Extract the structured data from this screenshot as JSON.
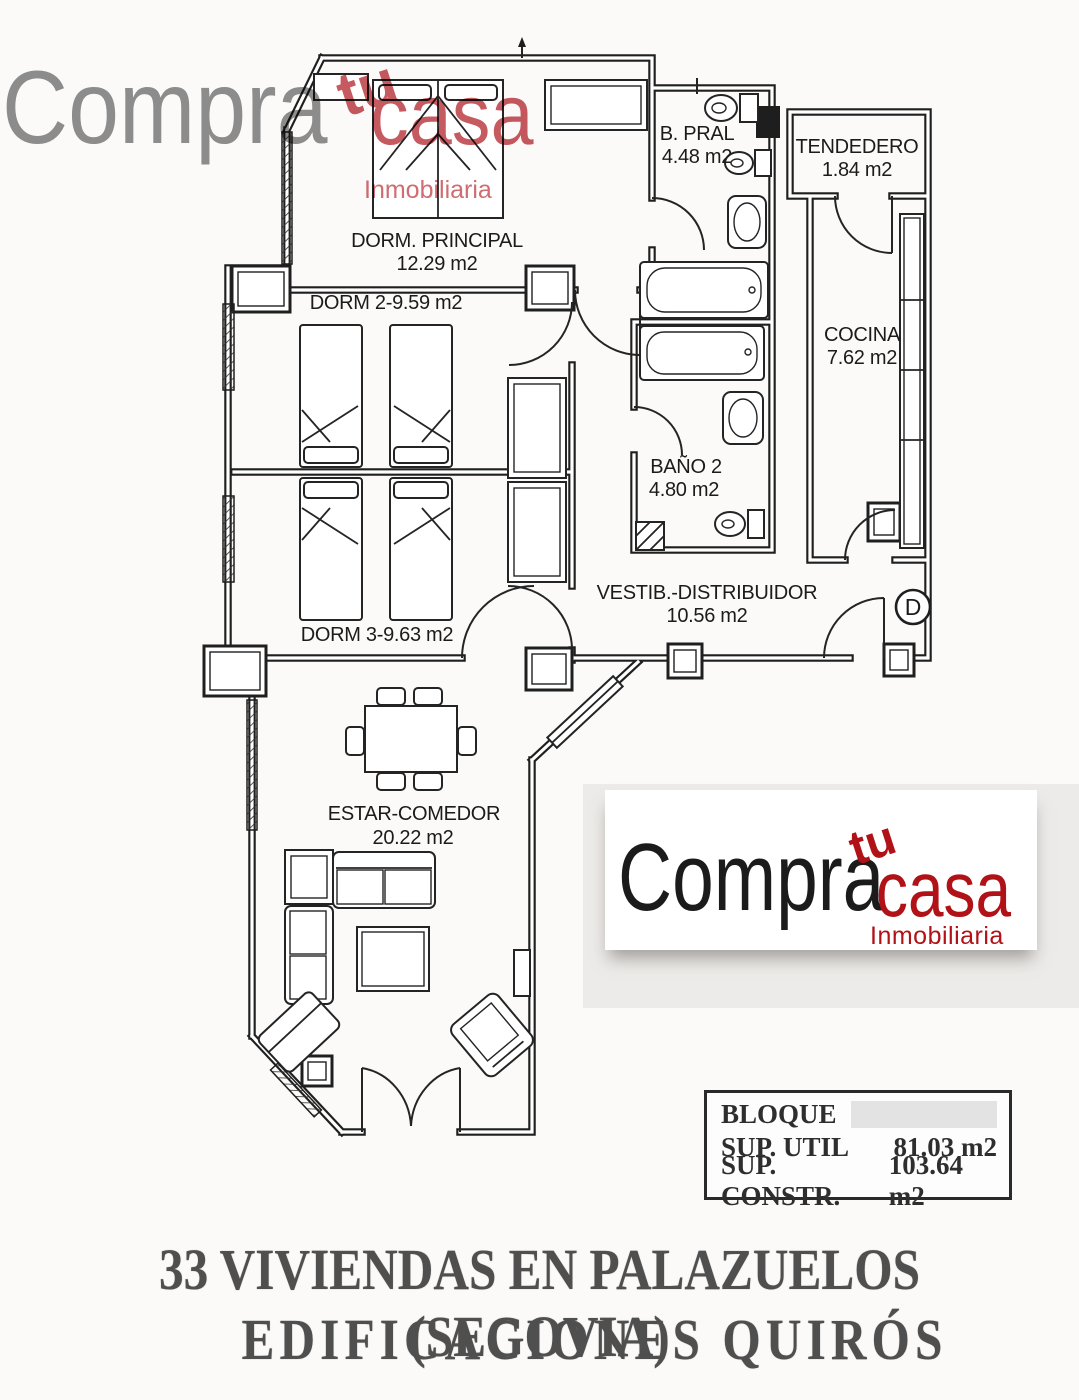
{
  "brand": {
    "word1": "Compra",
    "word2": "tu",
    "word3": "casa",
    "subtitle": "Inmobiliaria"
  },
  "colors": {
    "brand_gray": "#8f8f8f",
    "brand_red": "#b01217",
    "brand_red_faded": "#c55a60",
    "plan_line": "#1f1f1f",
    "caption_gray": "#4f4f4f"
  },
  "plan": {
    "rooms": {
      "dorm_principal": {
        "name": "DORM. PRINCIPAL",
        "area": "12.29 m2"
      },
      "dorm2": {
        "label": "DORM 2-9.59 m2"
      },
      "dorm3": {
        "label": "DORM 3-9.63 m2"
      },
      "b_pral": {
        "name": "B. PRAL",
        "area": "4.48 m2"
      },
      "tendedero": {
        "name": "TENDEDERO",
        "area": "1.84 m2"
      },
      "cocina": {
        "name": "COCINA",
        "area": "7.62 m2"
      },
      "bano2": {
        "name": "BAÑO 2",
        "area": "4.80 m2"
      },
      "vestibulo": {
        "name": "VESTIB.-DISTRIBUIDOR",
        "area": "10.56 m2"
      },
      "estar": {
        "name": "ESTAR-COMEDOR",
        "area": "20.22 m2"
      }
    },
    "entrance_marker": "D"
  },
  "summary": {
    "rows": [
      {
        "label": "BLOQUE",
        "value": ""
      },
      {
        "label": "SUP. UTIL",
        "value": "81.03 m2"
      },
      {
        "label": "SUP. CONSTR.",
        "value": "103.64 m2"
      }
    ]
  },
  "footer": {
    "line1": "33 VIVIENDAS EN PALAZUELOS (SEGOVIA)",
    "line2": "EDIFICACIONES QUIRÓS"
  }
}
